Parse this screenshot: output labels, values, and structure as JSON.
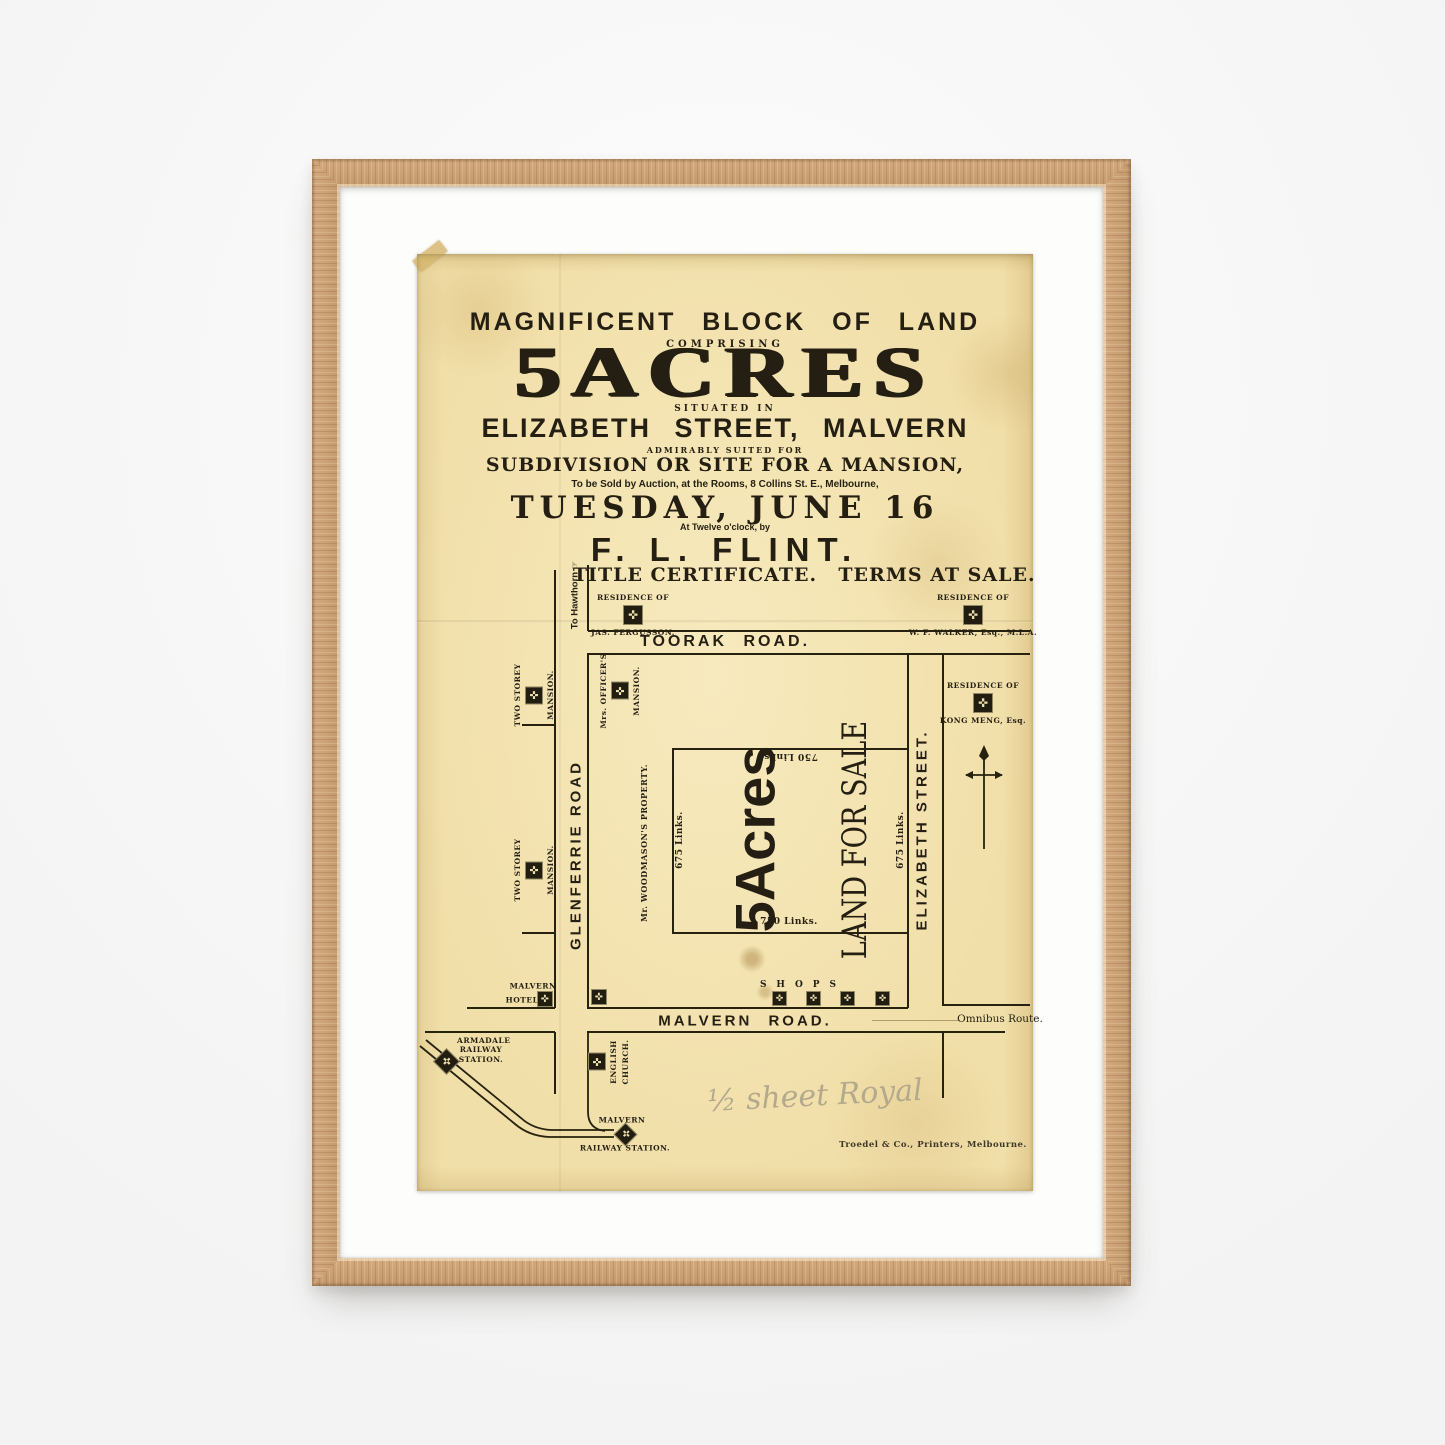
{
  "poster": {
    "headline": {
      "line1": "MAGNIFICENT BLOCK OF LAND",
      "comprising": "COMPRISING",
      "acres": "5ACRES",
      "situated_in": "SITUATED IN",
      "street_line": "ELIZABETH STREET, MALVERN",
      "admirably": "ADMIRABLY SUITED FOR",
      "subdivision": "SUBDIVISION OR SITE FOR A MANSION,",
      "auction_line": "To be Sold by Auction, at the Rooms, 8 Collins St. E., Melbourne,",
      "date": "TUESDAY, JUNE 16",
      "time_line": "At Twelve o'clock, by",
      "auctioneer": "F. L. FLINT.",
      "title_certificate": "TITLE CERTIFICATE.",
      "terms": "TERMS AT SALE."
    },
    "map": {
      "to_hawthorn": "To Hawthorn",
      "residence_of": "RESIDENCE OF",
      "fergusson": "JAS. FERGUSSON.",
      "walker": "W. F. WALKER, Esq., M.L.A.",
      "kong_meng": "KONG MENG, Esq.",
      "toorak_road": "TOORAK ROAD.",
      "glenferrie_road": "GLENFERRIE ROAD",
      "elizabeth_street": "ELIZABETH STREET.",
      "malvern_road": "MALVERN ROAD.",
      "two_storey": "TWO STOREY",
      "mansion": "MANSION.",
      "mrs_officers": "Mrs. OFFICER'S",
      "woodmason": "Mr. WOODMASON'S PROPERTY.",
      "links_750": "750 Links.",
      "links_675": "675 Links.",
      "plot_acres": "5Acres",
      "land_for_sale": "LAND FOR SALE",
      "shops": "SHOPS",
      "hotel_line1": "MALVERN",
      "hotel_line2": "HOTEL",
      "omnibus": "Omnibus Route.",
      "armadale_1": "ARMADALE",
      "armadale_2": "RAILWAY",
      "armadale_3": "STATION.",
      "church_1": "ENGLISH",
      "church_2": "CHURCH.",
      "station_1": "MALVERN",
      "station_2": "RAILWAY STATION."
    },
    "annotations": {
      "handwriting": "½ sheet Royal",
      "printer": "Troedel & Co., Printers, Melbourne."
    },
    "colors": {
      "paper": "#f1dfa9",
      "ink": "#26220f",
      "frame_wood": "#c79e74",
      "mat": "#fdfdfb",
      "wall": "#f6f6f6",
      "pencil": "#b3a98c"
    }
  }
}
